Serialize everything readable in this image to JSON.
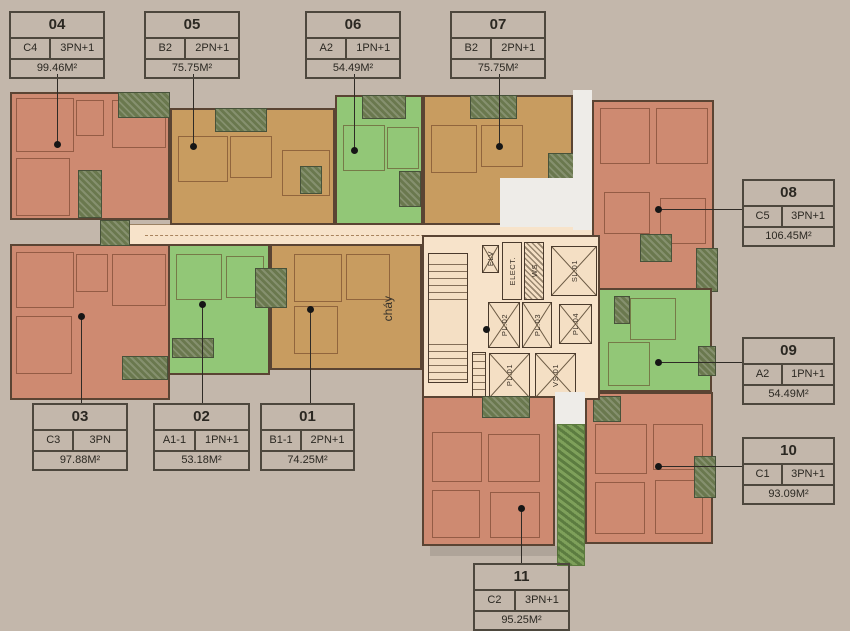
{
  "colors": {
    "background": "#c3b7ab",
    "unit_salmon": "#ce8a71",
    "unit_tan": "#c89c60",
    "unit_green": "#92c777",
    "balcony_olive": "#6a784e",
    "corridor": "#f7e3ca",
    "garden": "#7ea05a",
    "plan_outline": "#5a4433",
    "label_border": "#4d473d",
    "label_text": "#2b2822"
  },
  "units": [
    {
      "id": "04",
      "type": "C4",
      "rooms": "3PN+1",
      "area": "99.46M²"
    },
    {
      "id": "05",
      "type": "B2",
      "rooms": "2PN+1",
      "area": "75.75M²"
    },
    {
      "id": "06",
      "type": "A2",
      "rooms": "1PN+1",
      "area": "54.49M²"
    },
    {
      "id": "07",
      "type": "B2",
      "rooms": "2PN+1",
      "area": "75.75M²"
    },
    {
      "id": "08",
      "type": "C5",
      "rooms": "3PN+1",
      "area": "106.45M²"
    },
    {
      "id": "09",
      "type": "A2",
      "rooms": "1PN+1",
      "area": "54.49M²"
    },
    {
      "id": "10",
      "type": "C1",
      "rooms": "3PN+1",
      "area": "93.09M²"
    },
    {
      "id": "11",
      "type": "C2",
      "rooms": "3PN+1",
      "area": "95.25M²"
    },
    {
      "id": "03",
      "type": "C3",
      "rooms": "3PN",
      "area": "97.88M²"
    },
    {
      "id": "02",
      "type": "A1-1",
      "rooms": "1PN+1",
      "area": "53.18M²"
    },
    {
      "id": "01",
      "type": "B1-1",
      "rooms": "2PN+1",
      "area": "74.25M²"
    }
  ],
  "core": {
    "elv": "ELV",
    "elect": "ELECT.",
    "ws": "WS",
    "sl01": "SL.01",
    "pl02": "PL.02",
    "pl03": "PL.03",
    "pl04": "PL.04",
    "pl01": "PL.01",
    "vs01": "VS.01"
  },
  "annotations": {
    "fire_escape": "cháy"
  }
}
